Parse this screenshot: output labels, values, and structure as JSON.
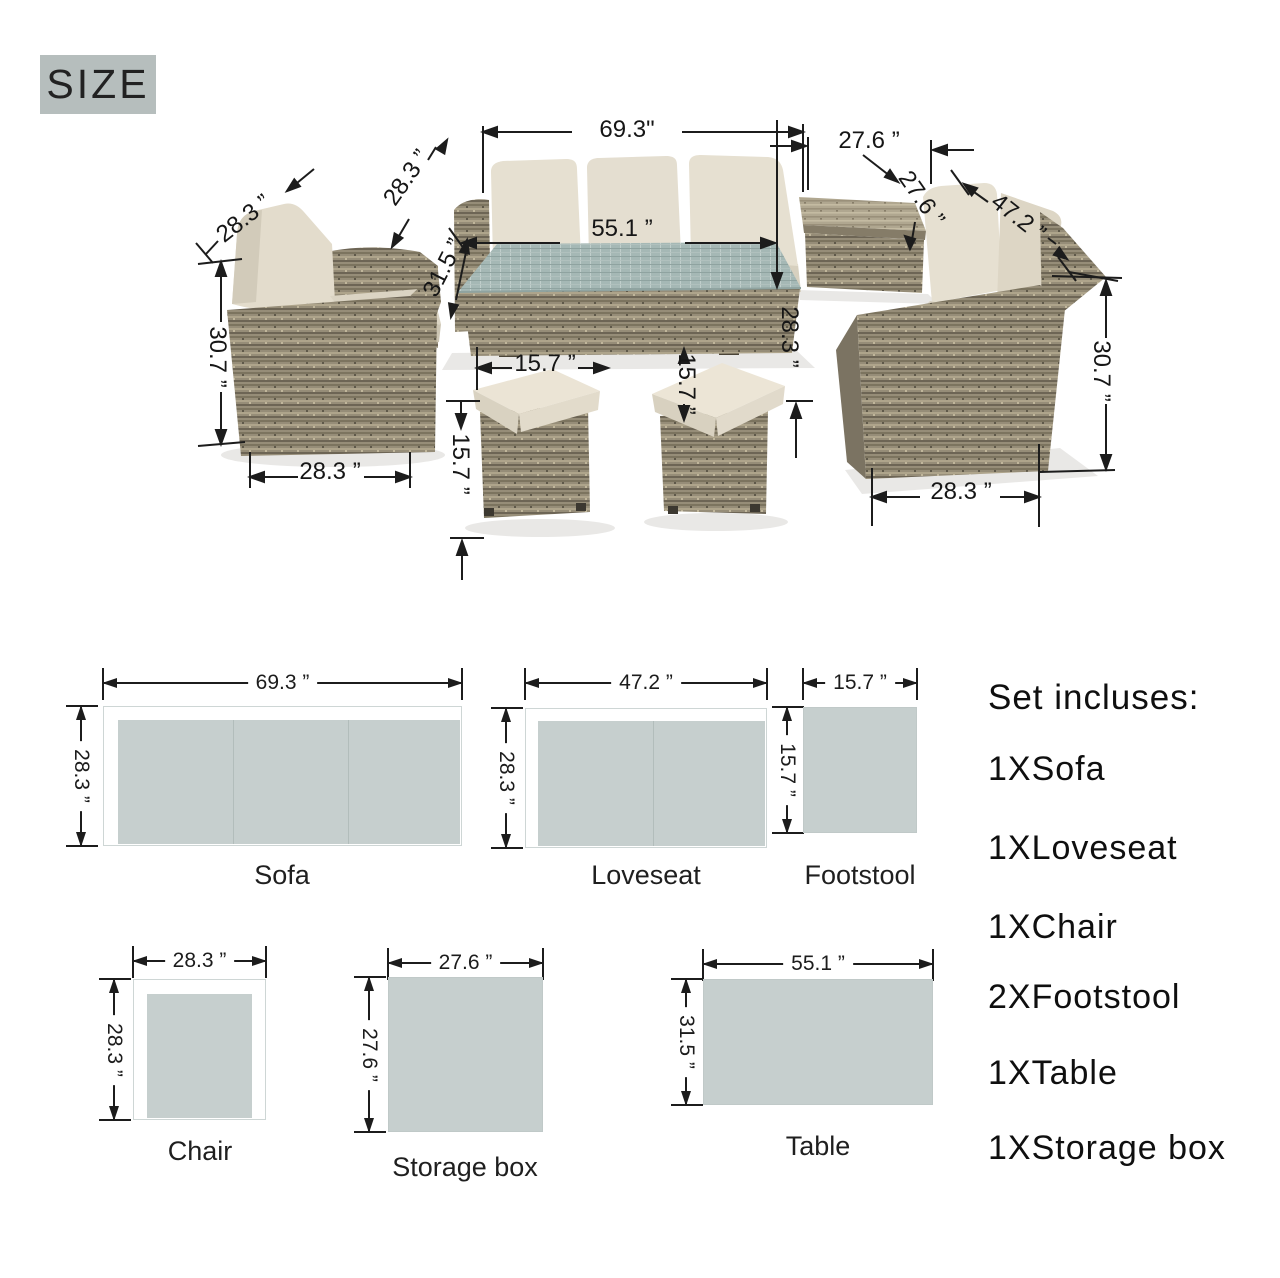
{
  "size_label": "SIZE",
  "colors": {
    "badge_bg": "#b6bebd",
    "schematic_fill": "#c6cfce",
    "wicker": "#968d78",
    "cushion": "#e5dfd0",
    "glass_top": "#a5b8b5",
    "line": "#1c1c1c"
  },
  "photo": {
    "annotations": [
      {
        "id": "sofa-width",
        "text": "69.3\""
      },
      {
        "id": "storage-width-top",
        "text": "27.6 ”"
      },
      {
        "id": "storage-depth",
        "text": "27.6 ”"
      },
      {
        "id": "loveseat-width",
        "text": "47.2 ”"
      },
      {
        "id": "chair-width-top",
        "text": "28.3 ”"
      },
      {
        "id": "sofa-depth",
        "text": "28.3 ”"
      },
      {
        "id": "table-depth",
        "text": "31.5 ”"
      },
      {
        "id": "table-width",
        "text": "55.1 ”"
      },
      {
        "id": "chair-height",
        "text": "30.7 ”"
      },
      {
        "id": "chair-width-bottom",
        "text": "28.3 ”"
      },
      {
        "id": "footstool-width",
        "text": "15.7 ”"
      },
      {
        "id": "footstool-depth",
        "text": "15.7 ”"
      },
      {
        "id": "footstool-height",
        "text": "15.7 ”"
      },
      {
        "id": "table-height",
        "text": "28.3 ”"
      },
      {
        "id": "loveseat-height",
        "text": "30.7 ”"
      },
      {
        "id": "loveseat-depth-bottom",
        "text": "28.3 ”"
      }
    ]
  },
  "schematics": [
    {
      "name": "Sofa",
      "width_label": "69.3 ”",
      "depth_label": "28.3 ”"
    },
    {
      "name": "Loveseat",
      "width_label": "47.2 ”",
      "depth_label": "28.3 ”"
    },
    {
      "name": "Footstool",
      "width_label": "15.7 ”",
      "depth_label": "15.7 ”"
    },
    {
      "name": "Chair",
      "width_label": "28.3 ”",
      "depth_label": "28.3 ”"
    },
    {
      "name": "Storage box",
      "width_label": "27.6 ”",
      "depth_label": "27.6 ”"
    },
    {
      "name": "Table",
      "width_label": "55.1 ”",
      "depth_label": "31.5 ”"
    }
  ],
  "set_includes": {
    "title": "Set incluses:",
    "items": [
      "1XSofa",
      "1XLoveseat",
      "1XChair",
      "2XFootstool",
      "1XTable",
      "1XStorage box"
    ]
  }
}
